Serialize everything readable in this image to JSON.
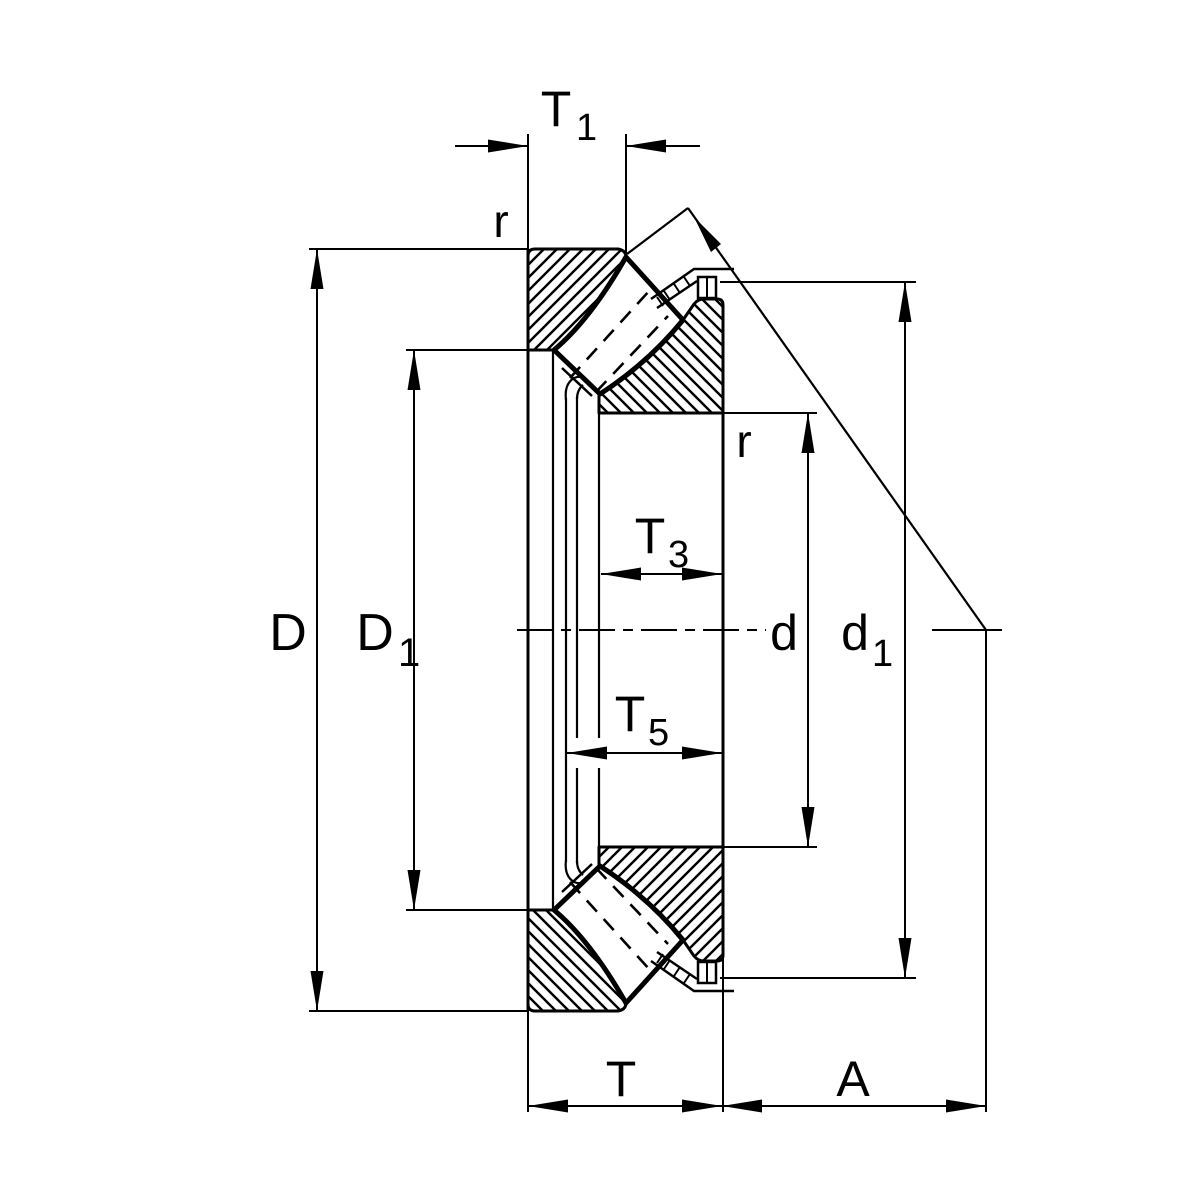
{
  "diagram": {
    "title": "Spherical roller thrust bearing cross-section with dimension annotations",
    "colors": {
      "line": "#000000",
      "background": "#ffffff"
    },
    "labels": {
      "t1": {
        "base": "T",
        "sub": "1"
      },
      "r_top": "r",
      "r_inner": "r",
      "D": "D",
      "D1": {
        "base": "D",
        "sub": "1"
      },
      "T3": {
        "base": "T",
        "sub": "3"
      },
      "T5": {
        "base": "T",
        "sub": "5"
      },
      "d": "d",
      "d1": {
        "base": "d",
        "sub": "1"
      },
      "T": "T",
      "A": "A"
    }
  }
}
